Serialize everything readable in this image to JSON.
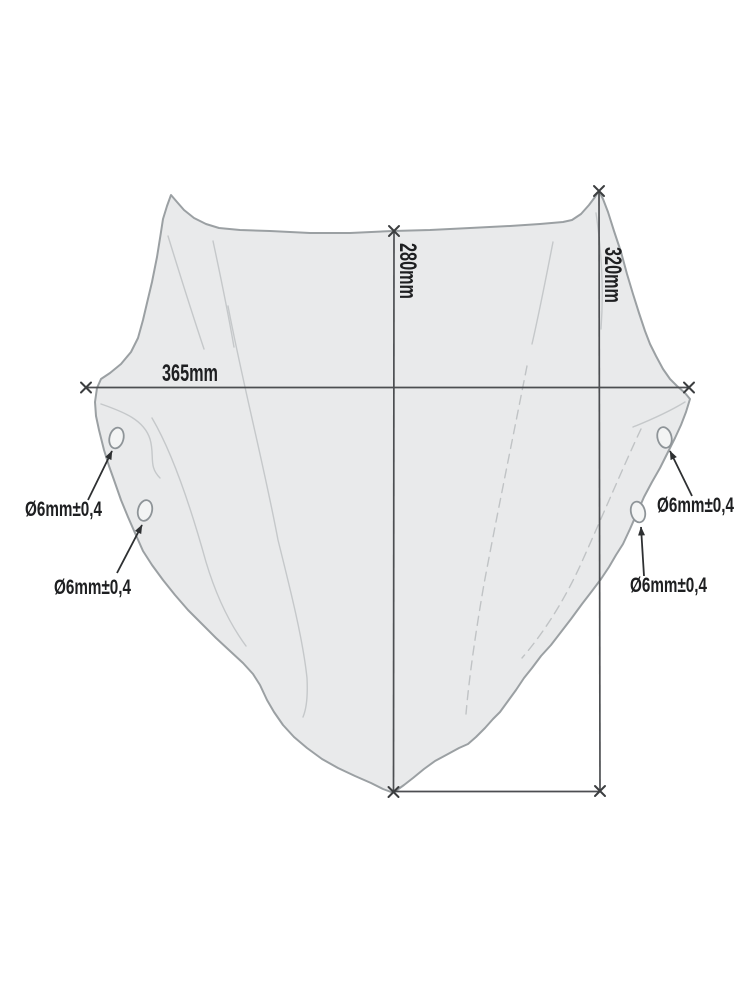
{
  "drawing": {
    "kind": "windscreen technical dimension drawing",
    "dimensions": [
      {
        "id": "width",
        "label": "365mm",
        "value_mm": 365,
        "orientation": "horizontal"
      },
      {
        "id": "height-center",
        "label": "280mm",
        "value_mm": 280,
        "orientation": "vertical"
      },
      {
        "id": "height-right",
        "label": "320mm",
        "value_mm": 320,
        "orientation": "vertical"
      }
    ],
    "holes": [
      {
        "id": "left-upper",
        "label": "Ø6mm±0,4",
        "diameter_mm": 6,
        "tolerance_mm": 0.4
      },
      {
        "id": "left-lower",
        "label": "Ø6mm±0,4",
        "diameter_mm": 6,
        "tolerance_mm": 0.4
      },
      {
        "id": "right-upper",
        "label": "Ø6mm±0,4",
        "diameter_mm": 6,
        "tolerance_mm": 0.4
      },
      {
        "id": "right-lower",
        "label": "Ø6mm±0,4",
        "diameter_mm": 6,
        "tolerance_mm": 0.4
      }
    ],
    "hole_count": 4,
    "colors": {
      "background": "#ffffff",
      "screen_fill": "#e9eaeb",
      "screen_outline": "#9ba0a3",
      "dimension_line": "#4c4e51",
      "text": "#1e1f21"
    }
  }
}
